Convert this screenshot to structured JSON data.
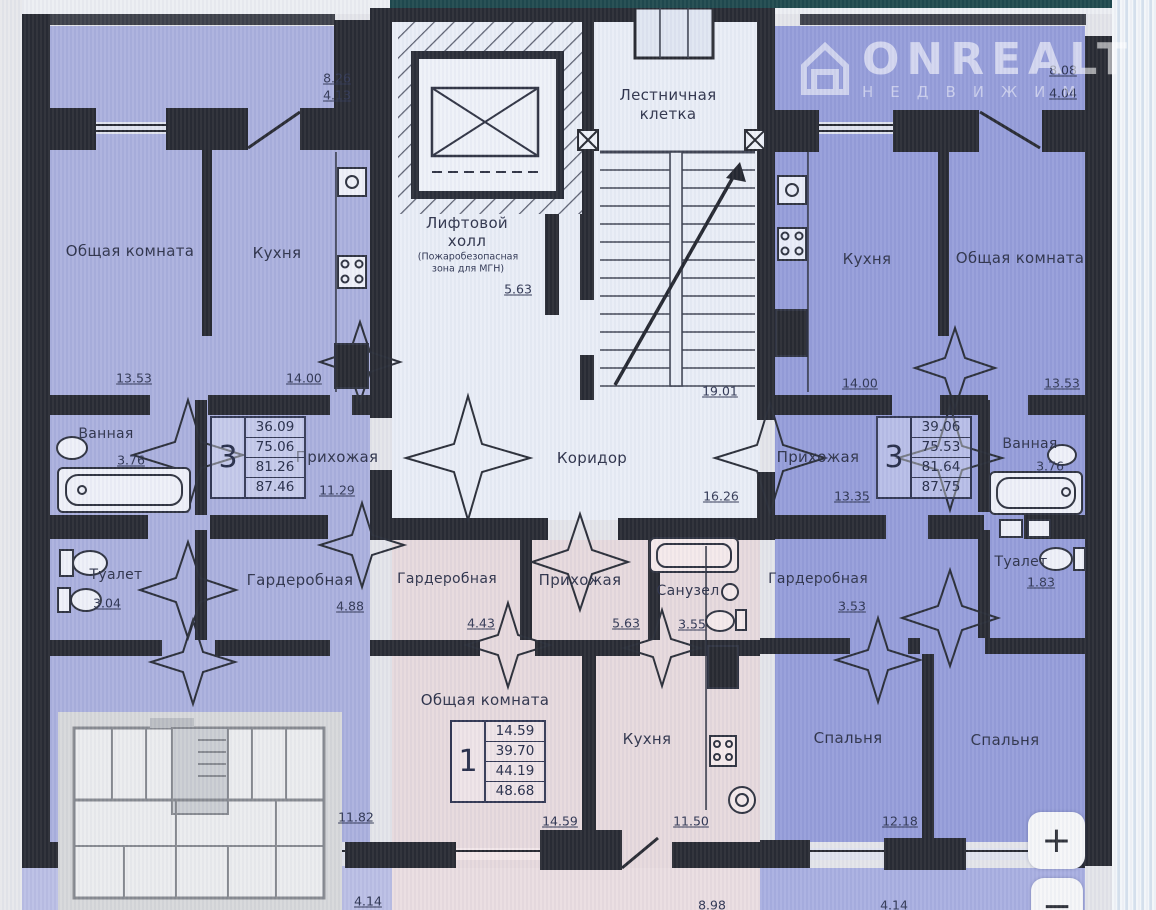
{
  "watermark": {
    "brand": "ONREALT",
    "subtitle": "НЕДВИЖИМ"
  },
  "zoom_controls": {
    "zoom_in": "+",
    "zoom_out": "−"
  },
  "core": {
    "stairwell": {
      "label_line1": "Лестничная",
      "label_line2": "клетка",
      "area": "19.01"
    },
    "elevator_hall": {
      "label_line1": "Лифтовой",
      "label_line2": "холл",
      "note_line1": "(Пожаробезопасная",
      "note_line2": "зона для МГН)",
      "area": "5.63"
    },
    "corridor": {
      "label": "Коридор",
      "area": "16.26"
    }
  },
  "apartments": {
    "left": {
      "type_table": {
        "rooms": "3",
        "areas": [
          "36.09",
          "75.06",
          "81.26",
          "87.46"
        ]
      },
      "balcony": {
        "area": "8.26",
        "area_reduced": "4.13"
      },
      "living": {
        "label": "Общая комната",
        "area": "13.53"
      },
      "kitchen": {
        "label": "Кухня",
        "area": "14.00"
      },
      "bathroom": {
        "label": "Ванная",
        "area": "3.76"
      },
      "hallway": {
        "label": "Прихожая",
        "area": "11.29"
      },
      "wc": {
        "label": "Туалет",
        "area": "3.04"
      },
      "wardrobe": {
        "label": "Гардеробная",
        "area": "4.88"
      },
      "bottom_room_dim": "11.82",
      "bottom_balcony_dim": "4.14"
    },
    "center": {
      "type_table": {
        "rooms": "1",
        "areas": [
          "14.59",
          "39.70",
          "44.19",
          "48.68"
        ]
      },
      "wardrobe": {
        "label": "Гардеробная",
        "area": "4.43"
      },
      "hallway": {
        "label": "Прихожая",
        "area": "5.63"
      },
      "sanuzel": {
        "label": "Санузел",
        "area": "3.55"
      },
      "living": {
        "label": "Общая комната",
        "area": "14.59"
      },
      "kitchen": {
        "label": "Кухня",
        "area": "11.50"
      },
      "bottom_balcony_dim": "8.98"
    },
    "right": {
      "type_table": {
        "rooms": "3",
        "areas": [
          "39.06",
          "75.53",
          "81.64",
          "87.75"
        ]
      },
      "balcony": {
        "area": "8.08",
        "area_reduced": "4.04"
      },
      "kitchen": {
        "label": "Кухня",
        "area": "14.00"
      },
      "living": {
        "label": "Общая комната",
        "area": "13.53"
      },
      "bathroom": {
        "label": "Ванная",
        "area": "3.76"
      },
      "hallway": {
        "label": "Прихожая",
        "area": "13.35"
      },
      "wc": {
        "label": "Туалет",
        "area": "1.83"
      },
      "wardrobe": {
        "label": "Гардеробная",
        "area": "3.53"
      },
      "bedroom1": {
        "label": "Спальня",
        "area": "12.18"
      },
      "bedroom2": {
        "label": "Спальня"
      },
      "bottom_balcony_dim": "4.14"
    }
  },
  "colors": {
    "left_apartment": "#a9aedd",
    "right_apartment": "#939bd8",
    "center_apartment": "#e6d8dc",
    "core": "#e9edf6",
    "walls": "#24262e"
  }
}
